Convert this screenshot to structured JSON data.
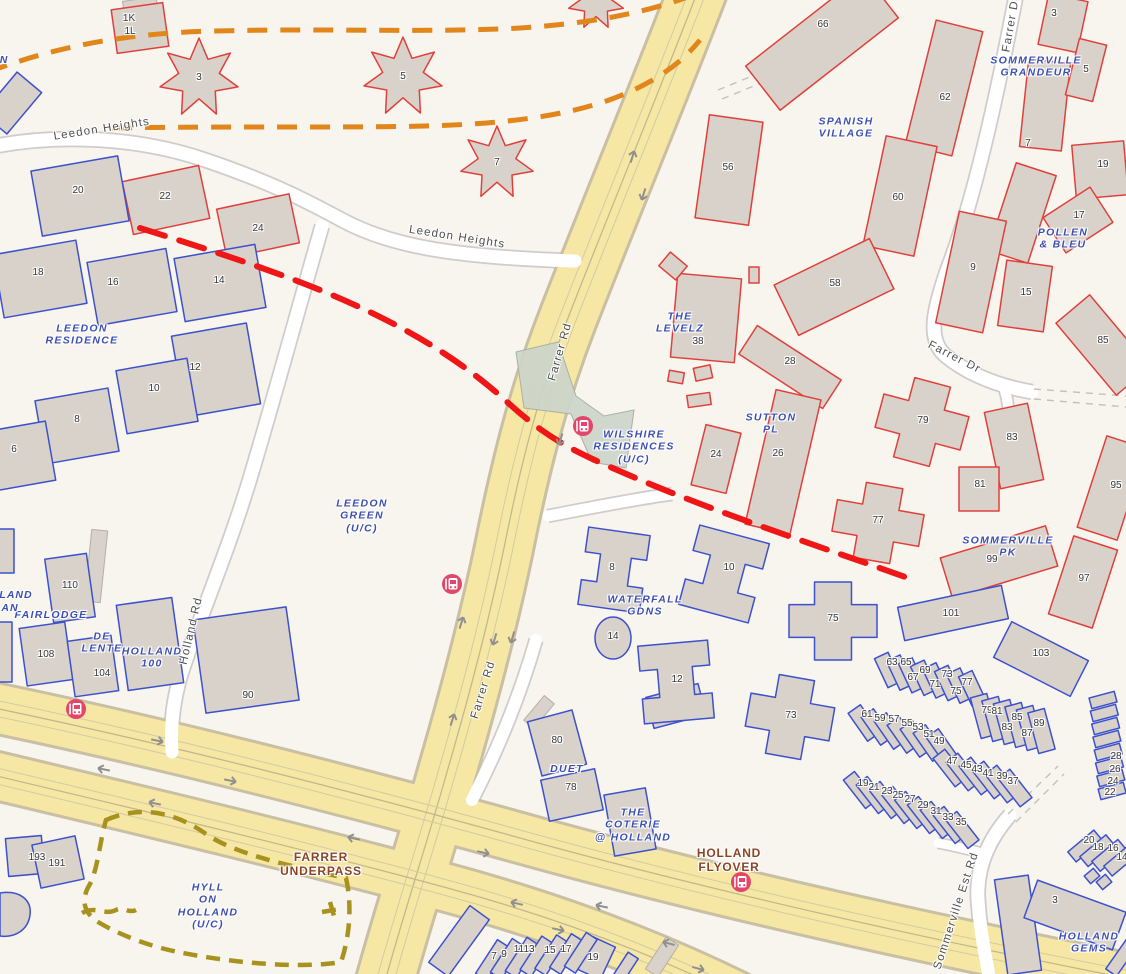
{
  "map": {
    "background": "#f8f4ee",
    "colors": {
      "building_fill": "#d9d2ca",
      "outline_red": "#e0403b",
      "outline_blue": "#3c51cc",
      "outline_gray": "#b5afa7",
      "road_major": "#f6e7a4",
      "road_major_casing": "#c9bfa2",
      "road_minor": "#ffffff",
      "road_minor_casing": "#cfcccb",
      "lane_line": "#c2b88f",
      "lane_line_light": "#d3caa5",
      "dash_orange": "#e0861a",
      "dash_red": "#ee1616",
      "dash_olive": "#a8921f",
      "bridge": "#ccd5ca",
      "arrow": "#909090",
      "bus": "#e2476b",
      "area_label": "#3c4fb1",
      "road_label": "#4f4f4f",
      "infra_label": "#8a4527"
    }
  },
  "area_labels": [
    {
      "text": "LEEDON\nRESIDENCE",
      "x": 82,
      "y": 335
    },
    {
      "text": "LEEDON\nGREEN\n(U/C)",
      "x": 362,
      "y": 516
    },
    {
      "text": "WILSHIRE\nRESIDENCES\n(U/C)",
      "x": 634,
      "y": 447
    },
    {
      "text": "SPANISH\nVILLAGE",
      "x": 846,
      "y": 128
    },
    {
      "text": "SOMMERVILLE\nGRANDEUR",
      "x": 1036,
      "y": 67
    },
    {
      "text": "POLLEN\n& BLEU",
      "x": 1063,
      "y": 239
    },
    {
      "text": "THE\nLEVELZ",
      "x": 680,
      "y": 323
    },
    {
      "text": "SUTTON\nPL",
      "x": 771,
      "y": 424
    },
    {
      "text": "SOMMERVILLE\nPK",
      "x": 1008,
      "y": 547
    },
    {
      "text": "WATERFALL\nGDNS",
      "x": 645,
      "y": 606
    },
    {
      "text": "FAIRLODGE",
      "x": 51,
      "y": 615
    },
    {
      "text": "DE\nLENTE",
      "x": 102,
      "y": 643
    },
    {
      "text": "HOLLAND\n100",
      "x": 152,
      "y": 658
    },
    {
      "text": "DUET",
      "x": 567,
      "y": 769
    },
    {
      "text": "THE\nCOTERIE\n@ HOLLAND",
      "x": 633,
      "y": 825
    },
    {
      "text": "HYLL\nON\nHOLLAND\n(U/C)",
      "x": 208,
      "y": 906
    },
    {
      "text": "HOLLAND\nGEMS",
      "x": 1089,
      "y": 943
    }
  ],
  "road_labels": [
    {
      "text": "Leedon Heights",
      "x": 102,
      "y": 130,
      "rot": -9
    },
    {
      "text": "Leedon Heights",
      "x": 457,
      "y": 238,
      "rot": 9
    },
    {
      "text": "Farrer Rd",
      "x": 561,
      "y": 352,
      "rot": -74
    },
    {
      "text": "Farrer Rd",
      "x": 484,
      "y": 690,
      "rot": -73
    },
    {
      "text": "Farrer Dr",
      "x": 1012,
      "y": 24,
      "rot": -80
    },
    {
      "text": "Farrer Dr",
      "x": 954,
      "y": 358,
      "rot": 27
    },
    {
      "text": "Holland Rd",
      "x": 192,
      "y": 631,
      "rot": -77
    },
    {
      "text": "Sommerville Est Rd",
      "x": 957,
      "y": 911,
      "rot": -72
    }
  ],
  "infra_labels": [
    {
      "text": "FARRER\nUNDERPASS",
      "x": 321,
      "y": 864
    },
    {
      "text": "HOLLAND\nFLYOVER",
      "x": 729,
      "y": 860
    }
  ],
  "partial_labels": [
    {
      "text": "N",
      "x": 4,
      "y": 60
    },
    {
      "text": "LAND",
      "x": 16,
      "y": 595
    },
    {
      "text": "AN",
      "x": 10,
      "y": 608
    }
  ],
  "building_numbers": [
    {
      "n": "1K",
      "x": 129,
      "y": 19
    },
    {
      "n": "1L",
      "x": 130,
      "y": 32
    },
    {
      "n": "3",
      "x": 199,
      "y": 78
    },
    {
      "n": "5",
      "x": 403,
      "y": 77
    },
    {
      "n": "7",
      "x": 497,
      "y": 163
    },
    {
      "n": "20",
      "x": 78,
      "y": 191
    },
    {
      "n": "22",
      "x": 165,
      "y": 197
    },
    {
      "n": "24",
      "x": 258,
      "y": 229
    },
    {
      "n": "18",
      "x": 38,
      "y": 273
    },
    {
      "n": "16",
      "x": 113,
      "y": 283
    },
    {
      "n": "14",
      "x": 219,
      "y": 281
    },
    {
      "n": "12",
      "x": 195,
      "y": 368
    },
    {
      "n": "10",
      "x": 154,
      "y": 389
    },
    {
      "n": "8",
      "x": 77,
      "y": 420
    },
    {
      "n": "6",
      "x": 14,
      "y": 450
    },
    {
      "n": "66",
      "x": 823,
      "y": 25
    },
    {
      "n": "62",
      "x": 945,
      "y": 98
    },
    {
      "n": "60",
      "x": 898,
      "y": 198
    },
    {
      "n": "56",
      "x": 728,
      "y": 168
    },
    {
      "n": "58",
      "x": 835,
      "y": 284
    },
    {
      "n": "38",
      "x": 698,
      "y": 342
    },
    {
      "n": "28",
      "x": 790,
      "y": 362
    },
    {
      "n": "24",
      "x": 716,
      "y": 455
    },
    {
      "n": "26",
      "x": 778,
      "y": 454
    },
    {
      "n": "79",
      "x": 923,
      "y": 421
    },
    {
      "n": "77",
      "x": 878,
      "y": 521
    },
    {
      "n": "3",
      "x": 1054,
      "y": 14
    },
    {
      "n": "5",
      "x": 1086,
      "y": 70
    },
    {
      "n": "7",
      "x": 1028,
      "y": 144
    },
    {
      "n": "19",
      "x": 1103,
      "y": 165
    },
    {
      "n": "17",
      "x": 1079,
      "y": 216
    },
    {
      "n": "9",
      "x": 973,
      "y": 268
    },
    {
      "n": "15",
      "x": 1026,
      "y": 293
    },
    {
      "n": "85",
      "x": 1103,
      "y": 341
    },
    {
      "n": "83",
      "x": 1012,
      "y": 438
    },
    {
      "n": "81",
      "x": 980,
      "y": 485
    },
    {
      "n": "95",
      "x": 1116,
      "y": 486
    },
    {
      "n": "99",
      "x": 992,
      "y": 560
    },
    {
      "n": "97",
      "x": 1084,
      "y": 579
    },
    {
      "n": "101",
      "x": 951,
      "y": 614
    },
    {
      "n": "103",
      "x": 1041,
      "y": 654
    },
    {
      "n": "8",
      "x": 612,
      "y": 568
    },
    {
      "n": "10",
      "x": 729,
      "y": 568
    },
    {
      "n": "14",
      "x": 613,
      "y": 637
    },
    {
      "n": "12",
      "x": 677,
      "y": 680
    },
    {
      "n": "75",
      "x": 833,
      "y": 619
    },
    {
      "n": "73",
      "x": 791,
      "y": 716
    },
    {
      "n": "90",
      "x": 248,
      "y": 696
    },
    {
      "n": "110",
      "x": 70,
      "y": 586
    },
    {
      "n": "108",
      "x": 46,
      "y": 655
    },
    {
      "n": "104",
      "x": 102,
      "y": 674
    },
    {
      "n": "80",
      "x": 557,
      "y": 741
    },
    {
      "n": "78",
      "x": 571,
      "y": 788
    },
    {
      "n": "193",
      "x": 37,
      "y": 858
    },
    {
      "n": "191",
      "x": 57,
      "y": 864
    },
    {
      "n": "63",
      "x": 892,
      "y": 663
    },
    {
      "n": "65",
      "x": 906,
      "y": 663
    },
    {
      "n": "67",
      "x": 913,
      "y": 678
    },
    {
      "n": "69",
      "x": 925,
      "y": 671
    },
    {
      "n": "71",
      "x": 935,
      "y": 685
    },
    {
      "n": "73",
      "x": 947,
      "y": 675
    },
    {
      "n": "75",
      "x": 956,
      "y": 692
    },
    {
      "n": "77",
      "x": 967,
      "y": 683
    },
    {
      "n": "61",
      "x": 867,
      "y": 715
    },
    {
      "n": "59",
      "x": 880,
      "y": 719
    },
    {
      "n": "57",
      "x": 894,
      "y": 720
    },
    {
      "n": "55",
      "x": 907,
      "y": 724
    },
    {
      "n": "53",
      "x": 918,
      "y": 728
    },
    {
      "n": "51",
      "x": 929,
      "y": 735
    },
    {
      "n": "49",
      "x": 939,
      "y": 742
    },
    {
      "n": "79",
      "x": 987,
      "y": 711
    },
    {
      "n": "81",
      "x": 997,
      "y": 712
    },
    {
      "n": "83",
      "x": 1007,
      "y": 728
    },
    {
      "n": "85",
      "x": 1017,
      "y": 718
    },
    {
      "n": "87",
      "x": 1027,
      "y": 734
    },
    {
      "n": "89",
      "x": 1039,
      "y": 724
    },
    {
      "n": "47",
      "x": 952,
      "y": 762
    },
    {
      "n": "45",
      "x": 966,
      "y": 766
    },
    {
      "n": "43",
      "x": 977,
      "y": 770
    },
    {
      "n": "41",
      "x": 988,
      "y": 774
    },
    {
      "n": "39",
      "x": 1002,
      "y": 777
    },
    {
      "n": "37",
      "x": 1013,
      "y": 782
    },
    {
      "n": "19",
      "x": 863,
      "y": 784
    },
    {
      "n": "21",
      "x": 874,
      "y": 788
    },
    {
      "n": "23",
      "x": 887,
      "y": 792
    },
    {
      "n": "25",
      "x": 898,
      "y": 796
    },
    {
      "n": "27",
      "x": 910,
      "y": 800
    },
    {
      "n": "29",
      "x": 923,
      "y": 806
    },
    {
      "n": "31",
      "x": 936,
      "y": 812
    },
    {
      "n": "33",
      "x": 948,
      "y": 818
    },
    {
      "n": "35",
      "x": 961,
      "y": 823
    },
    {
      "n": "28",
      "x": 1116,
      "y": 757
    },
    {
      "n": "26",
      "x": 1115,
      "y": 770
    },
    {
      "n": "24",
      "x": 1113,
      "y": 782
    },
    {
      "n": "22",
      "x": 1110,
      "y": 793
    },
    {
      "n": "20",
      "x": 1089,
      "y": 841
    },
    {
      "n": "18",
      "x": 1098,
      "y": 848
    },
    {
      "n": "16",
      "x": 1113,
      "y": 849
    },
    {
      "n": "14",
      "x": 1122,
      "y": 858
    },
    {
      "n": "3",
      "x": 1055,
      "y": 901
    },
    {
      "n": "7",
      "x": 494,
      "y": 957
    },
    {
      "n": "9",
      "x": 504,
      "y": 955
    },
    {
      "n": "11",
      "x": 519,
      "y": 950
    },
    {
      "n": "13",
      "x": 529,
      "y": 950
    },
    {
      "n": "15",
      "x": 550,
      "y": 951
    },
    {
      "n": "17",
      "x": 566,
      "y": 950
    },
    {
      "n": "19",
      "x": 593,
      "y": 958
    }
  ],
  "bus_stops": [
    {
      "x": 583,
      "y": 426
    },
    {
      "x": 452,
      "y": 584
    },
    {
      "x": 76,
      "y": 709
    },
    {
      "x": 741,
      "y": 882
    }
  ]
}
